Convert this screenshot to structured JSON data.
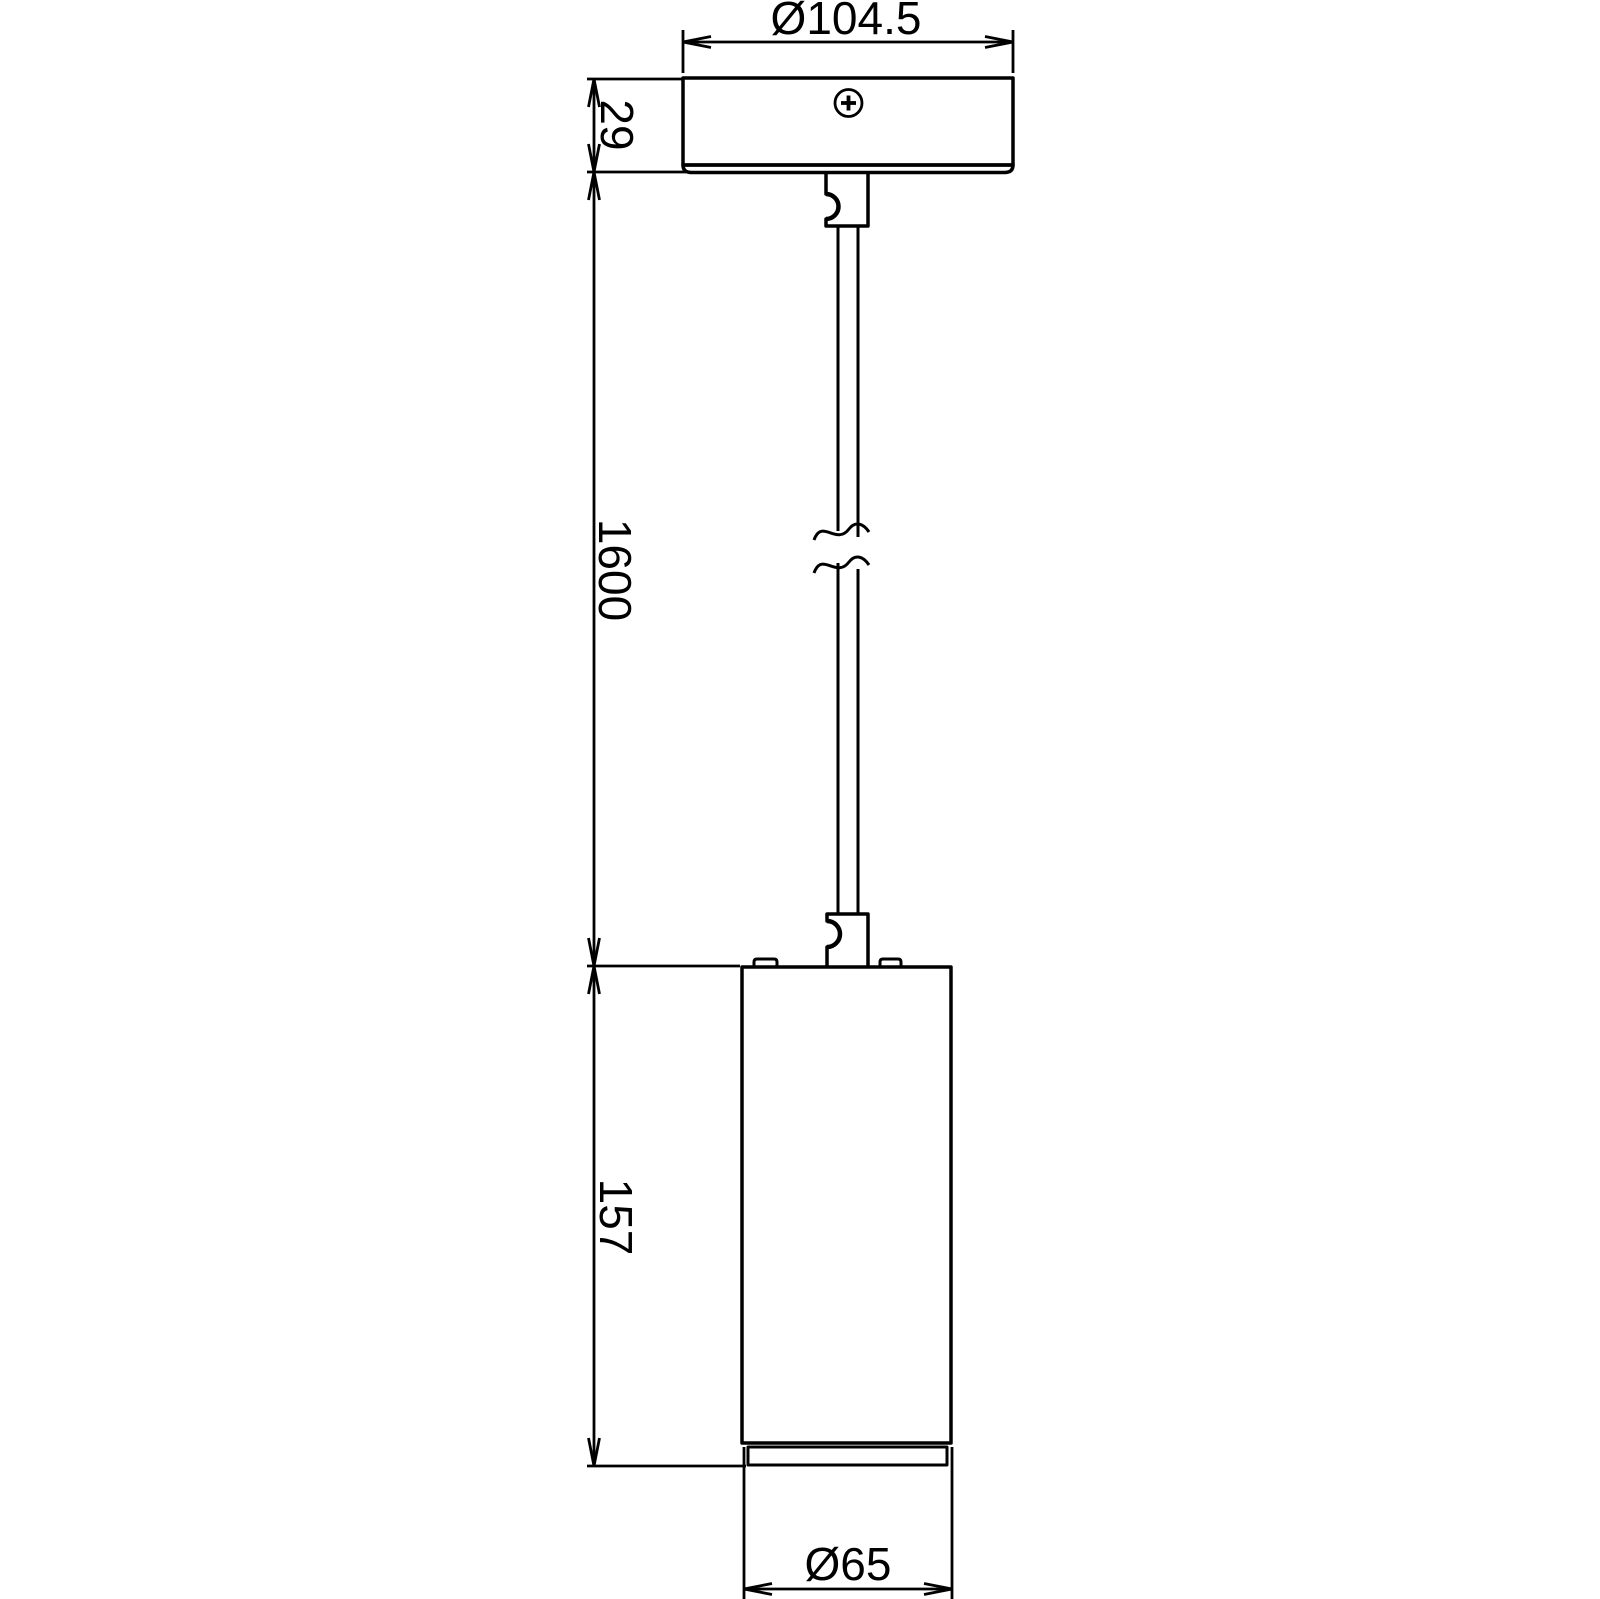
{
  "drawing": {
    "background_color": "#ffffff",
    "line_color": "#000000",
    "type": "technical-dimension-drawing",
    "subject": "pendant-light",
    "dimensions": {
      "canopy_diameter": {
        "label": "Ø104.5"
      },
      "canopy_height": {
        "label": "29"
      },
      "cable_length": {
        "label": "1600"
      },
      "body_height": {
        "label": "157"
      },
      "body_diameter": {
        "label": "Ø65"
      }
    },
    "parts": [
      "ceiling-canopy",
      "mounting-screw",
      "strain-relief",
      "suspension-cable",
      "cable-break-symbol",
      "lamp-body",
      "trim-ring"
    ]
  }
}
